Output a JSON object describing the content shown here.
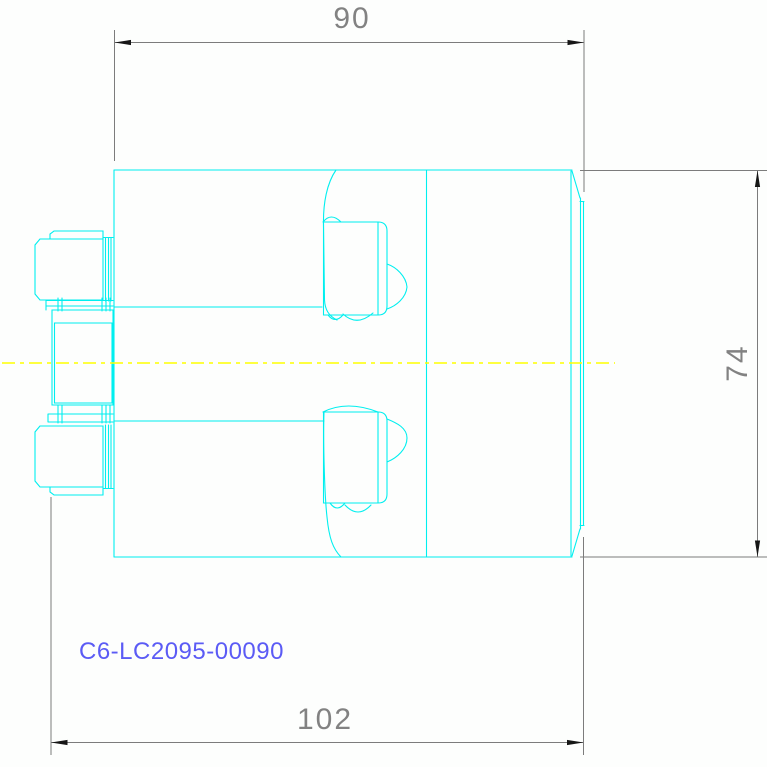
{
  "drawing": {
    "part_number": "C6-LC2095-00090",
    "dimensions": {
      "top_width": "90",
      "right_height": "74",
      "bottom_width": "102"
    },
    "colors": {
      "geometry": "#00efef",
      "centerline": "#ffff00",
      "dimension_line": "#7c7c7c",
      "arrow": "#161616",
      "part_number_text": "#5b5bf5",
      "dimension_text": "#828282",
      "background": "#fdfefd"
    }
  }
}
